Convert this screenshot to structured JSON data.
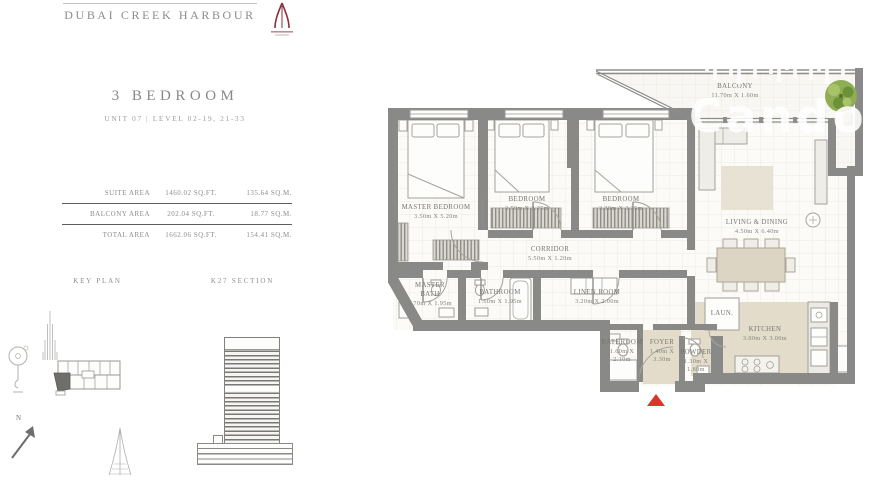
{
  "header": {
    "title": "DUBAI CREEK HARBOUR"
  },
  "unit": {
    "type": "3 BEDROOM",
    "subtitle": "UNIT 07 | LEVEL 02-19, 21-33"
  },
  "areas": {
    "rows": [
      {
        "label": "SUITE AREA",
        "sqft": "1460.02 SQ.FT.",
        "sqm": "135.64 SQ.M."
      },
      {
        "label": "BALCONY AREA",
        "sqft": "202.04 SQ.FT.",
        "sqm": "18.77 SQ.M."
      },
      {
        "label": "TOTAL AREA",
        "sqft": "1662.06 SQ.FT.",
        "sqm": "154.41 SQ.M."
      }
    ]
  },
  "key_plan": {
    "label": "KEY PLAN",
    "north_label": "N"
  },
  "key_section": {
    "label": "K27 SECTION"
  },
  "floor_plan": {
    "watermark": "Cando",
    "rooms": [
      {
        "name": "MASTER BEDROOM",
        "dims": "3.50m X 5.20m"
      },
      {
        "name": "BEDROOM",
        "dims": "3.50m X 3.25m"
      },
      {
        "name": "BEDROOM",
        "dims": "3.30m X 3.25m"
      },
      {
        "name": "CORRIDOR",
        "dims": "5.50m X 1.20m"
      },
      {
        "name": "MASTER BATH",
        "dims": "2.70m X 1.95m"
      },
      {
        "name": "BATHROOM",
        "dims": "1.60m X 1.95m"
      },
      {
        "name": "LINEN ROOM",
        "dims": "3.20m X 2.00m"
      },
      {
        "name": "LIVING & DINING",
        "dims": "4.50m X 6.40m"
      },
      {
        "name": "BALCONY",
        "dims": "11.70m X 1.60m"
      },
      {
        "name": "KITCHEN",
        "dims": "3.00m X 3.00m"
      },
      {
        "name": "LAUN.",
        "dims": ""
      },
      {
        "name": "FOYER",
        "dims": "1.40m X 3.30m"
      },
      {
        "name": "POWDER",
        "dims": "1.30m X 1.80m"
      },
      {
        "name": "BATHROOM",
        "dims": "1.60m X 2.10m"
      }
    ]
  }
}
